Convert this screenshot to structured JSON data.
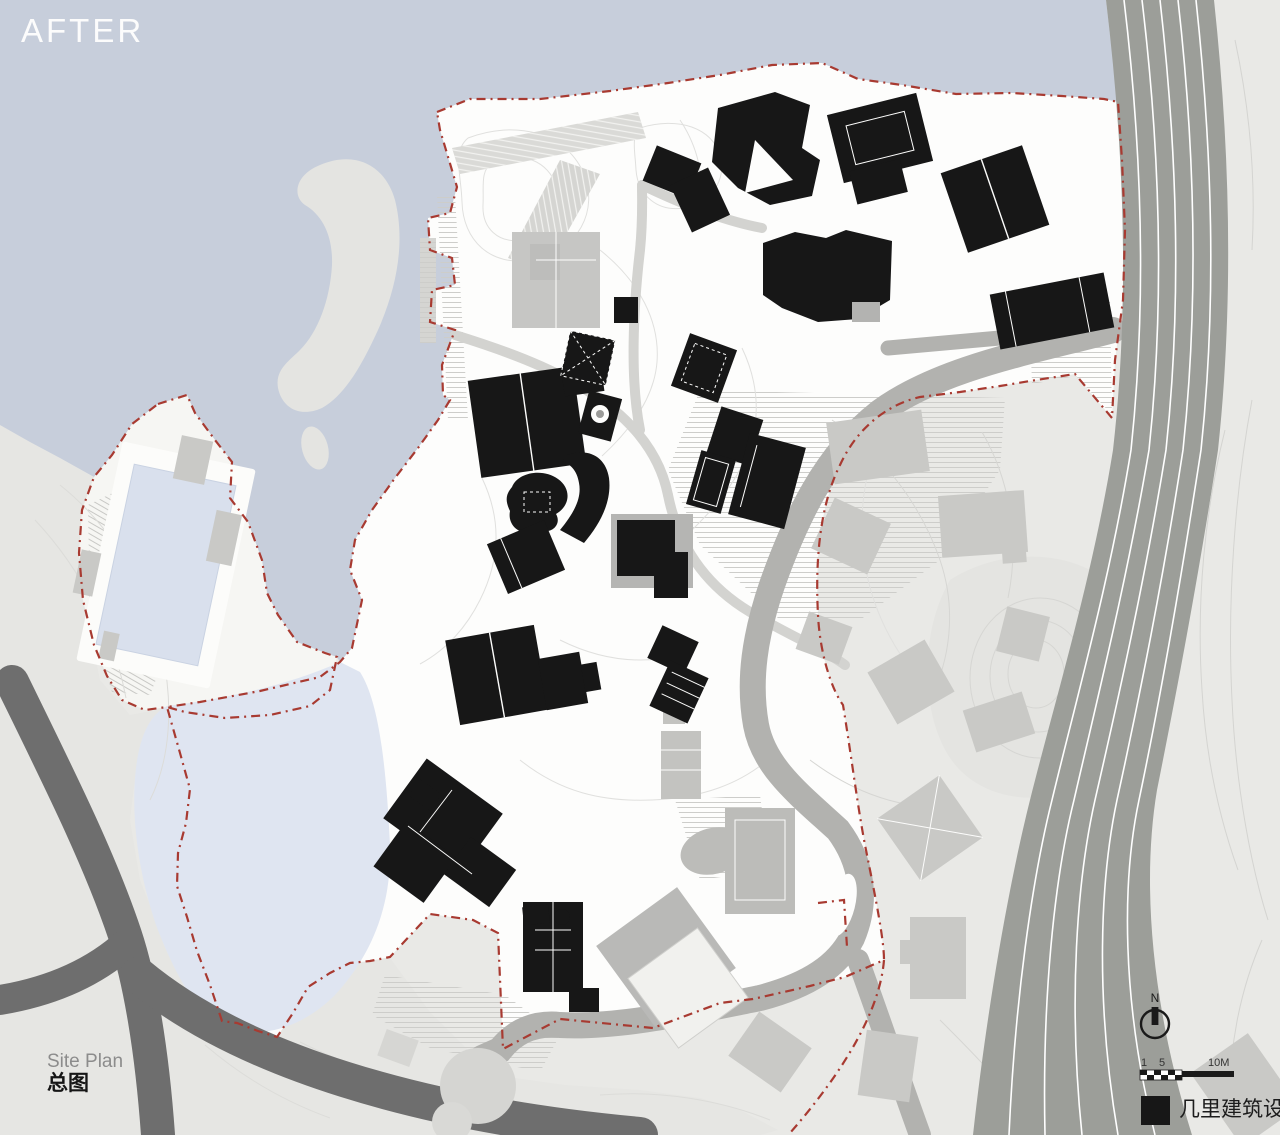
{
  "title": "AFTER",
  "caption": {
    "en": "Site Plan",
    "zh": "总图"
  },
  "compass": {
    "label": "N"
  },
  "scale_bar": {
    "tick_1": "1",
    "tick_5": "5",
    "tick_10": "10M"
  },
  "legend": {
    "firm_label": "几里建筑设计",
    "swatch_color": "#171717"
  },
  "colors": {
    "sea": "#c7cedb",
    "lake": "#dfe5f1",
    "pool": "#d9e0ed",
    "site_white": "#fdfdfc",
    "land": "#e9e9e6",
    "land_southwest": "#e6e6e3",
    "island": "#e4e4e1",
    "peninsula": "#f6f6f3",
    "road_dark": "#6e6e6e",
    "road_mid": "#b2b2af",
    "highway": "#9c9e99",
    "lane_line": "#ffffff",
    "building_black": "#171717",
    "building_context": "#c9c9c6",
    "boundary_red": "#a83a31",
    "contour": "#d8d8d5"
  }
}
